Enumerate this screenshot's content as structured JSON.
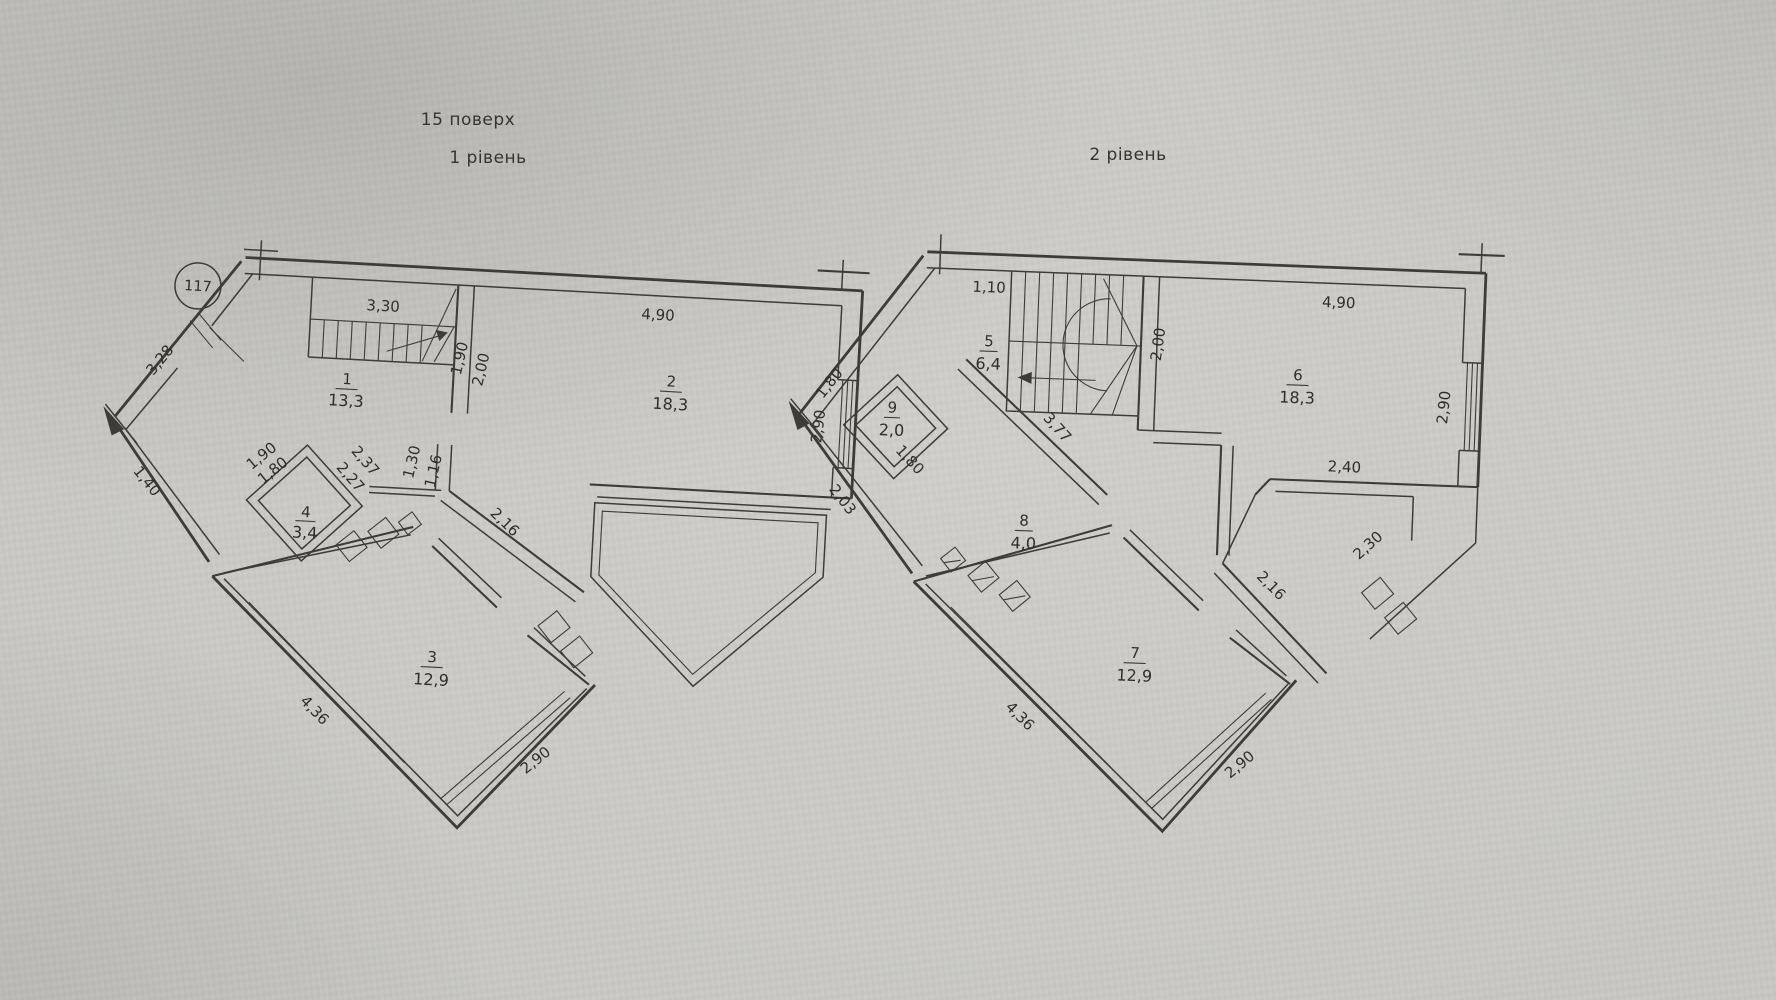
{
  "page": {
    "floor_title": "15 поверх",
    "level1_title": "1 рівень",
    "level2_title": "2 рівень",
    "apartment_number": "117",
    "paper_color": "#c9c8c2",
    "line_color": "#3d3c38"
  },
  "level1": {
    "rooms": {
      "r1": {
        "num": "1",
        "area": "13,3"
      },
      "r2": {
        "num": "2",
        "area": "18,3"
      },
      "r3": {
        "num": "3",
        "area": "12,9"
      },
      "r4": {
        "num": "4",
        "area": "3,4"
      }
    },
    "dims": {
      "stair": "3,30",
      "top": "4,90",
      "right": "2,90",
      "entry": "3,28",
      "left": "1,40",
      "hall_a": "1,90",
      "hall_b": "2,00",
      "stub_a": "1,30",
      "stub_b": "1,16",
      "wc_a": "1,90",
      "wc_b": "1,80",
      "wc_c": "2,37",
      "wc_d": "2,27",
      "diag": "2,16",
      "bottom_left": "4,36",
      "bottom_right": "2,90"
    }
  },
  "level2": {
    "rooms": {
      "r5": {
        "num": "5",
        "area": "6,4"
      },
      "r6": {
        "num": "6",
        "area": "18,3"
      },
      "r7": {
        "num": "7",
        "area": "12,9"
      },
      "r8": {
        "num": "8",
        "area": "4,0"
      },
      "r9": {
        "num": "9",
        "area": "2,0"
      }
    },
    "dims": {
      "top_left": "1,10",
      "top": "4,90",
      "stair_side": "2,00",
      "right": "2,90",
      "step": "2,40",
      "terrace_a": "2,30",
      "terrace_b": "2,16",
      "hall": "3,77",
      "entry": "1,80",
      "wc": "1,80",
      "side": "2,03",
      "bottom_left": "4,36",
      "bottom_right": "2,90"
    }
  }
}
